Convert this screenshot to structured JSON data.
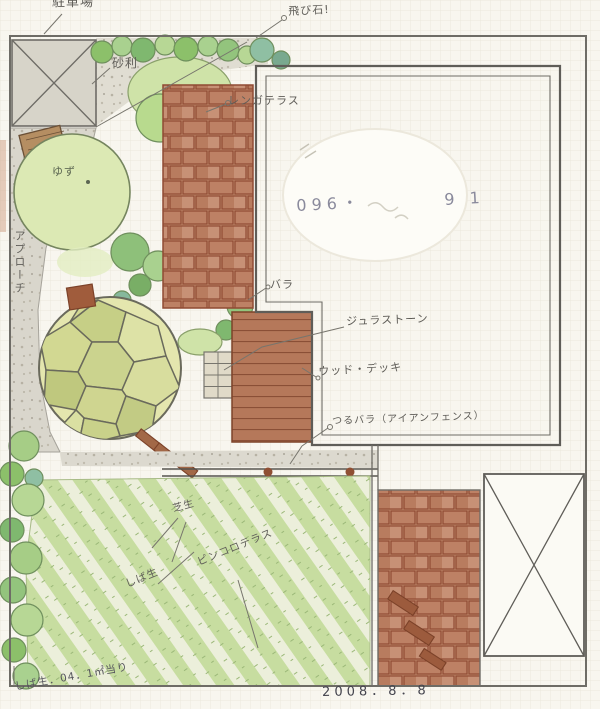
{
  "plan": {
    "date": "2008．8．8",
    "phone_prefix": "096・",
    "phone_suffix": "9 1",
    "corner_note": "しば生．04．1㎡当り"
  },
  "labels": {
    "parking": "駐車場",
    "stepping_stones_note": "飛び石!",
    "gravel": "砂利",
    "brick_terrace": "レンガテラス",
    "rose": "バラ",
    "jura_stone": "ジュラストーン",
    "wood_deck": "ウッド・デッキ",
    "climbing_rose_iron_fence": "つるバラ（アイアンフェンス）",
    "lawn": "芝生",
    "lawn_note": "しば生",
    "pinkoro_terrace": "ピンコロテラス",
    "approach": "アプローチ",
    "yuzu_tree": "ゆず"
  },
  "colors": {
    "paper": "#f8f6ef",
    "grid": "#e7e3d6",
    "pencil": "#6e6c66",
    "brick": "#c18a6d",
    "brick_line": "#8f4a33",
    "deck_wood": "#b5785a",
    "lawn_green": "#c7dda0",
    "tree_green": "#a6cd86",
    "stone_circle": "#d5db9c",
    "gravel": "#dcd9cf"
  }
}
